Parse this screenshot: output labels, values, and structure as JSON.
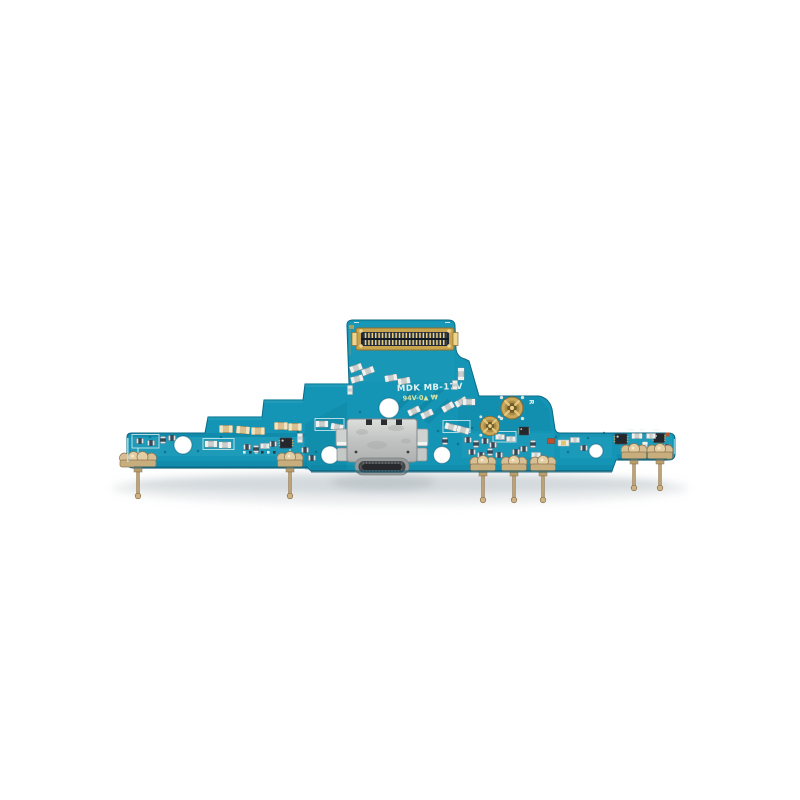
{
  "photo": {
    "alt": "Top-down product photo of a teal charging-port flex PCB on a white background, with a USB-C port at center, a gold board-to-board connector on the top tab, two gold RF coax connectors, black IC chips, small SMD components and gold spring contacts with test pins along the bottom edge",
    "background": "#ffffff"
  },
  "board": {
    "silkscreen": {
      "line1": "MDK MB-17V",
      "line2": "94V-0▲ ₩",
      "marking_r": "R"
    },
    "colors": {
      "background": "#ffffff",
      "board": "#1495b5",
      "board-light": "#41b4cd",
      "board-dark": "#0a7392",
      "board-edge": "#0a6a86",
      "silk-white": "#e2f2f2",
      "silk-yellow": "#d9e6a4",
      "gold": "#c8a44e",
      "gold-light": "#eed48c",
      "contact-gold": "#cfb68c",
      "silver": "#c9cdcc",
      "ic-black": "#24272c",
      "usb-silver": "#c6c9c7",
      "shadow": "#b9c2c6"
    },
    "parts": {
      "b2b_connector": "board-to-board-connector",
      "usb_port": "usb-c-port",
      "coax_connector": "rf-coax-connector",
      "spring_contact": "antenna-spring-contact",
      "screw_hole": "screw-hole",
      "ic": "ic-chip",
      "capacitor": "smd-capacitor",
      "inductor": "smd-inductor"
    }
  }
}
